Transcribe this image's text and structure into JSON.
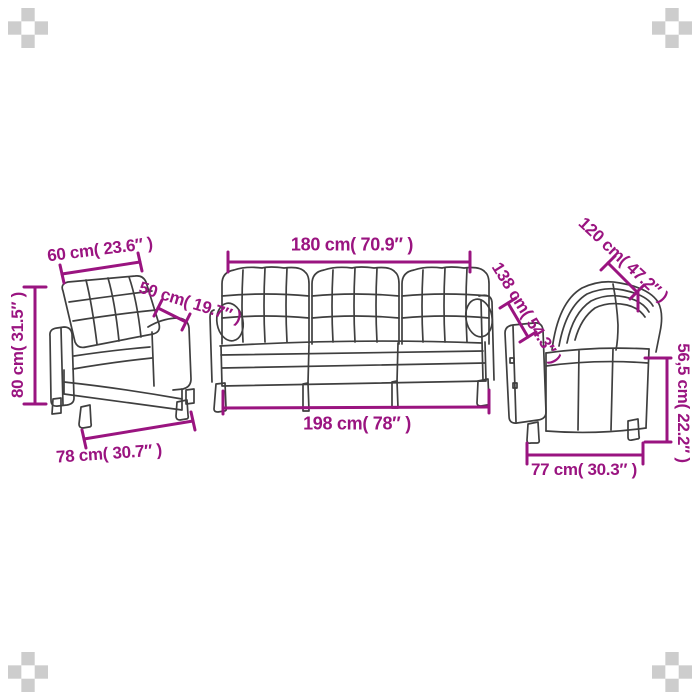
{
  "meta": {
    "background_color": "#ffffff",
    "accent_color": "#9A1480",
    "drawing_line_color": "#3f3f3f",
    "corner_checker_color": "#cdcdcd"
  },
  "items": [
    {
      "name": "armchair"
    },
    {
      "name": "three-seater-sofa"
    },
    {
      "name": "two-seater-sofa"
    }
  ],
  "labels": {
    "armchair_width_top": "60 cm( 23.6″ )",
    "armchair_depth": "50 cm( 19.7″ )",
    "armchair_height": "80 cm( 31.5″ )",
    "armchair_width_bottom": "78 cm( 30.7″ )",
    "sofa3_width_top": "180 cm( 70.9″ )",
    "sofa3_width_bottom": "198 cm( 78″ )",
    "sofa2_width_top": "120 cm( 47.2″ )",
    "sofa2_depth": "138 cm( 54.3″ )",
    "sofa2_height": "56,5 cm( 22.2″ )",
    "sofa2_width_bottom": "77 cm( 30.3″ )"
  }
}
